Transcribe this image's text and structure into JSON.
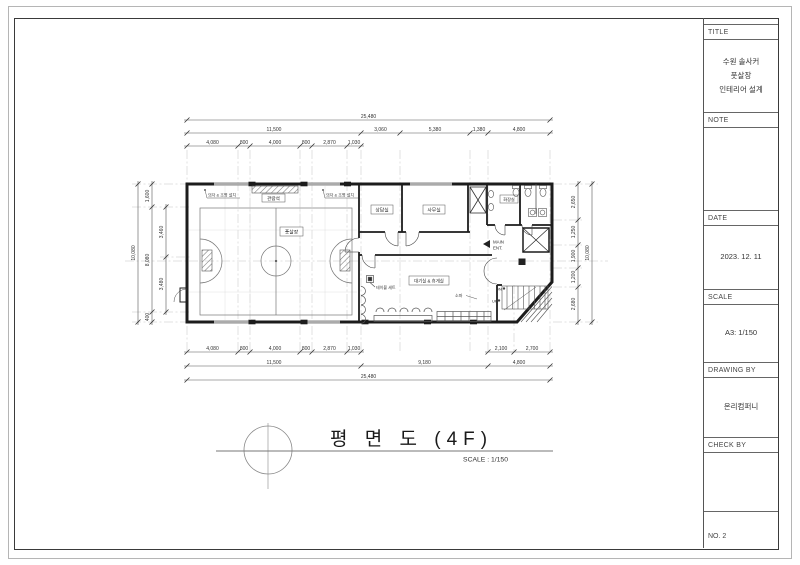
{
  "title_block": {
    "title_label": "TITLE",
    "title_lines": [
      "수원 솔사커",
      "풋살장",
      "인테리어 설계"
    ],
    "note_label": "NOTE",
    "date_label": "DATE",
    "date_value": "2023. 12. 11",
    "scale_label": "SCALE",
    "scale_value": "A3: 1/150",
    "drawing_by_label": "DRAWING BY",
    "drawing_by_value": "온리컴퍼니",
    "check_by_label": "CHECK BY",
    "no_value": "NO. 2"
  },
  "drawing_title": {
    "text": "평  면  도  (4F)",
    "scale": "SCALE : 1/150"
  },
  "rooms": {
    "futsal": "풋살장",
    "consult": "상담실",
    "office": "사무실",
    "waiting": "대기실 & 휴게실",
    "toilet": "화장실",
    "bleacher": "관람석"
  },
  "annotations": {
    "left_note": "의자 & 조명 설치",
    "right_note": "의자 & 조명 설치",
    "table_set": "테이블 세트",
    "sofa": "소파",
    "main_ent_1": "MAIN",
    "main_ent_2": "ENT.",
    "dn": "DN",
    "up": "UP"
  },
  "dimensions": {
    "top_total": "25,480",
    "top_tier2": [
      "11,500",
      "3,060",
      "5,380",
      "1,380",
      "4,800"
    ],
    "top_tier3": [
      "4,080",
      "800",
      "4,000",
      "800",
      "2,870",
      "1,030"
    ],
    "bottom_tier1": [
      "4,080",
      "800",
      "4,000",
      "800",
      "2,870",
      "1,030",
      "2,100",
      "2,700"
    ],
    "bottom_tier2": [
      "11,500",
      "9,180",
      "4,800"
    ],
    "bottom_total": "25,480",
    "left_total": "10,080",
    "left_tier2": [
      "1,600",
      "8,080",
      "400"
    ],
    "left_tier3": [
      "3,460",
      "3,480"
    ],
    "right_tier": [
      "2,650",
      "1,250",
      "1,900",
      "1,200",
      "2,680"
    ],
    "right_total": "10,080"
  }
}
